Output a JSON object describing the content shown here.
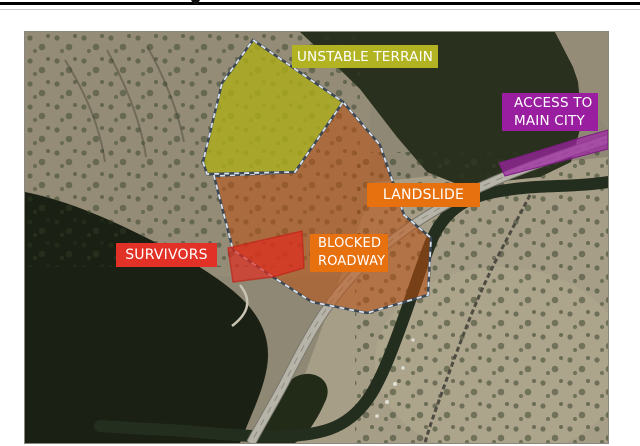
{
  "page": {
    "background": "#ffffff",
    "top_rule_color": "#000000"
  },
  "map": {
    "kind": "aerial-satellite-photo",
    "labels": {
      "unstable_terrain": {
        "text": "UNSTABLE TERRAIN",
        "color": "#b1b322"
      },
      "access_city": {
        "line1": "ACCESS TO",
        "line2": "MAIN CITY",
        "color": "#9a1fa0"
      },
      "landslide": {
        "text": "LANDSLIDE",
        "color": "#e8710f"
      },
      "blocked_roadway": {
        "line1": "BLOCKED",
        "line2": "ROADWAY",
        "color": "#e8710f"
      },
      "survivors": {
        "text": "SURVIVORS",
        "color": "#e23126"
      }
    },
    "regions": [
      {
        "name": "unstable-terrain-zone",
        "fill": "#acae18",
        "border": "gray dashed"
      },
      {
        "name": "landslide-zone",
        "fill": "#bc5012",
        "border": "gray dashed"
      },
      {
        "name": "survivor-zone",
        "fill": "#e12a1e",
        "border": "none"
      },
      {
        "name": "access-road-segment",
        "fill": "#9e24a4",
        "border": "none"
      }
    ]
  }
}
